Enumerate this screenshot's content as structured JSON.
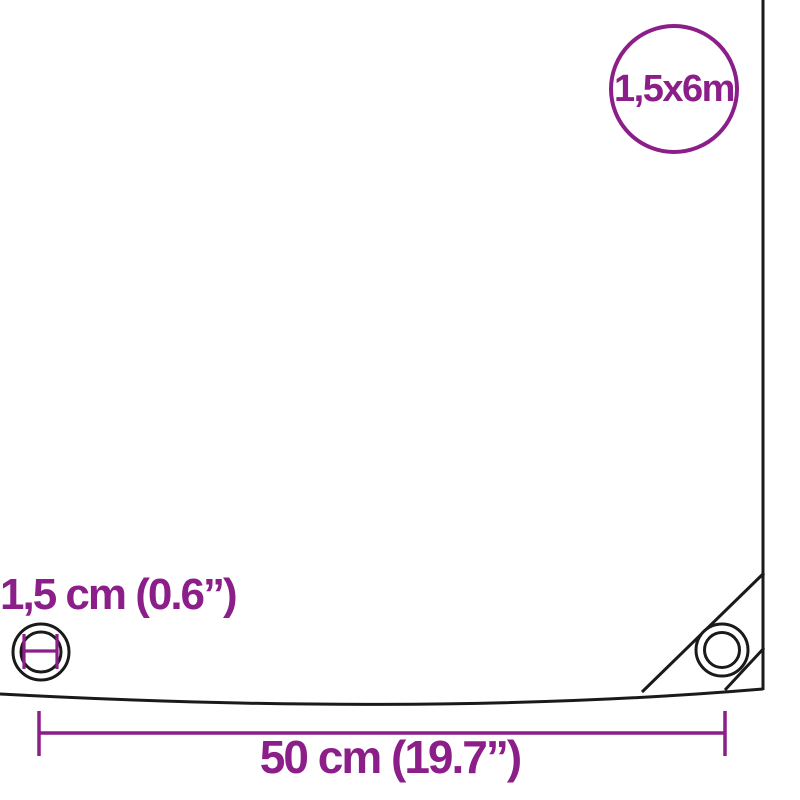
{
  "diagram": {
    "size_badge_label": "1,5x6m",
    "eyelet_diameter_label": "1,5 cm (0.6”)",
    "eyelet_spacing_label": "50 cm (19.7”)"
  },
  "colors": {
    "accent": "#8b1e88",
    "outline": "#1a1a1a"
  }
}
